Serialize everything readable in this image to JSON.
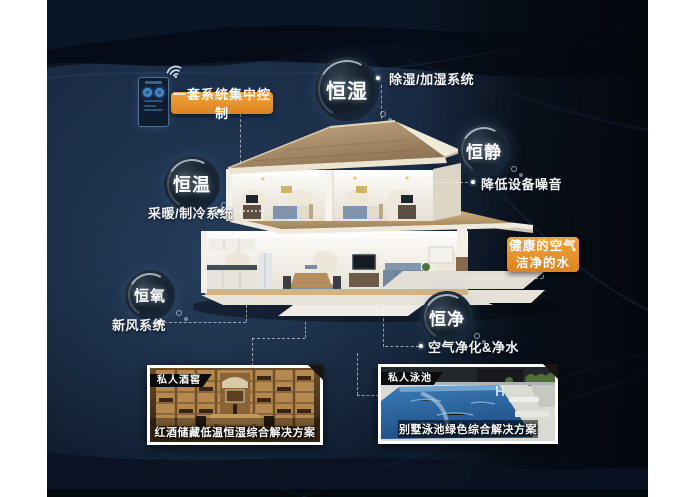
{
  "poster": {
    "colors": {
      "background_navy": "#16263c",
      "background_black": "#080d15",
      "accent_orange": "#e59130",
      "roof_tan": "#b99c74",
      "text_white": "#ffffff"
    },
    "control": {
      "banner_label": "一套系统集中控制",
      "wifi_icon": "wifi-icon",
      "panel_icon": "smart-control-panel"
    },
    "callouts": {
      "humidity": {
        "bubble": "恒湿",
        "label": "除湿/加湿系统"
      },
      "quiet": {
        "bubble": "恒静",
        "label": "降低设备噪音"
      },
      "temperature": {
        "bubble": "恒温",
        "label": "采暖/制冷系统"
      },
      "oxygen": {
        "bubble": "恒氧",
        "label": "新风系统"
      },
      "purity": {
        "bubble": "恒净",
        "label": "空气净化&净水"
      }
    },
    "highlight_box": {
      "line1": "健康的空气",
      "line2": "洁净的水"
    },
    "cards": {
      "wine": {
        "tag": "私人酒窖",
        "caption": "红酒储藏低温恒湿综合解决方案"
      },
      "pool": {
        "tag": "私人泳池",
        "caption": "别墅泳池绿色综合解决方案"
      }
    }
  }
}
